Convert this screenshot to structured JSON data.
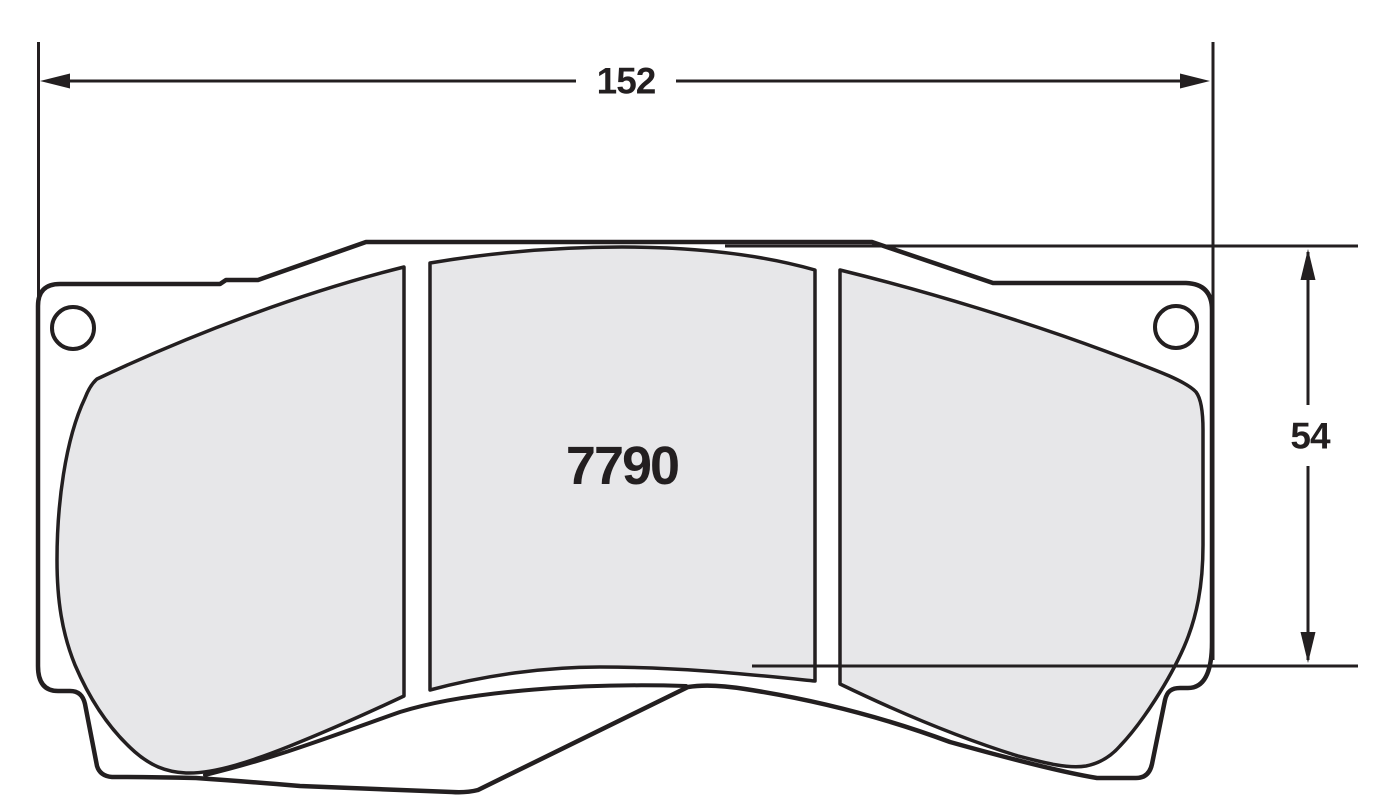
{
  "drawing": {
    "type_label": "brake-pad-dimension-drawing",
    "part_number": "7790",
    "dim_width": "152",
    "dim_height": "54",
    "colors": {
      "line": "#231f20",
      "friction_fill": "#e7e7e9",
      "plate_fill": "#ffffff",
      "background": "#ffffff"
    }
  }
}
